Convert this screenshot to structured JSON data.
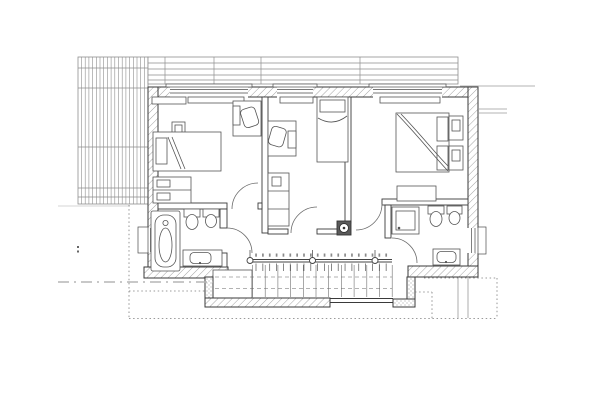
{
  "document": {
    "kind": "architectural floor plan",
    "view": "upper-floor plan, black-and-white CAD line drawing, no visible text labels",
    "background": "#ffffff"
  },
  "colors": {
    "line": "#3a3a3a",
    "thin_line": "#555555",
    "hatch": "#a3a3a3",
    "roof_line": "#8e8e8e",
    "dotted_outline": "#7a7a7a",
    "section_line": "#b5b5b5",
    "chimney_fill": "#5a5a5a"
  },
  "rooms": [
    {
      "id": "bedroom-left",
      "label": "bedroom top-left",
      "fixtures": [
        "single bed",
        "pillow",
        "nightstand",
        "wall shelf",
        "radiator",
        "desk with chair",
        "wardrobe",
        "window",
        "door"
      ]
    },
    {
      "id": "bedroom-middle",
      "label": "bedroom top-middle",
      "fixtures": [
        "single bed",
        "pillow",
        "desk with chair",
        "monitor",
        "tall wardrobe",
        "radiator",
        "window",
        "door"
      ]
    },
    {
      "id": "bedroom-master",
      "label": "bedroom top-right",
      "fixtures": [
        "double bed",
        "two pillows",
        "two nightstands",
        "bench",
        "radiator",
        "window",
        "door"
      ]
    },
    {
      "id": "bathroom-left",
      "label": "bathroom bottom-left",
      "fixtures": [
        "bathtub",
        "toilet",
        "bidet",
        "washbasin",
        "window",
        "door"
      ]
    },
    {
      "id": "bathroom-right",
      "label": "bathroom bottom-right",
      "fixtures": [
        "shower",
        "toilet",
        "bidet",
        "washbasin",
        "window",
        "door"
      ]
    },
    {
      "id": "hallway",
      "label": "hallway and landing",
      "fixtures": [
        "chimney flue",
        "stair opening with railing"
      ]
    },
    {
      "id": "balcony",
      "label": "balcony terrace at bottom",
      "fixtures": [
        "hatched parapet walls",
        "stair flight",
        "landing slab"
      ]
    }
  ],
  "stairs": {
    "tread_lines": 12,
    "balusters": 20,
    "railing_posts": 3,
    "number_marks": 20,
    "note": "tiny illegible step numerals above railing"
  },
  "roof": {
    "left_panel_plank_lines": 18,
    "top_band_lines": 6
  },
  "annotations": {
    "section_line": "grey dash-dot section line at lower left",
    "roof_outline": "dotted stepped roof outline around lower edge",
    "eave_lines": "short faint eave lines extending right of the plan"
  }
}
